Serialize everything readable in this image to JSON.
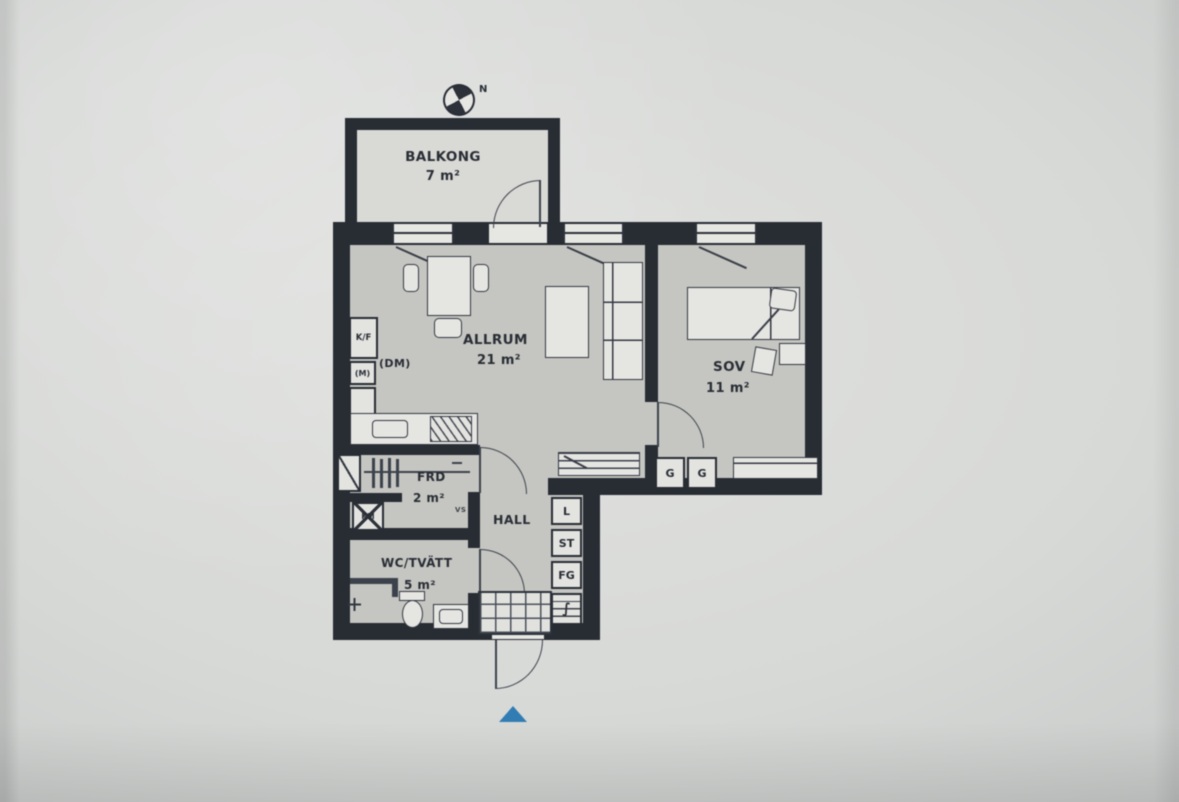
{
  "plan": {
    "compass_north": "N",
    "balcony": {
      "name": "BALKONG",
      "area": "7 m²"
    },
    "living": {
      "name": "ALLRUM",
      "area": "21 m²"
    },
    "bedroom": {
      "name": "SOV",
      "area": "11 m²"
    },
    "storage": {
      "name": "FRD",
      "area": "2 m²",
      "shaft_label": "VS"
    },
    "hall": {
      "name": "HALL"
    },
    "bath": {
      "name": "WC/TVÄTT",
      "area": "5 m²"
    },
    "kitchen": {
      "fridge_freezer": "K/F",
      "microwave": "(M)",
      "dishwasher": "(DM)"
    },
    "laundry": {
      "washing_machine": "KM",
      "el_symbol": "∫"
    },
    "wardrobes": {
      "g1": "G",
      "g2": "G",
      "linen": "L",
      "cleaning": "ST",
      "fg": "FG"
    }
  },
  "colors": {
    "wall": "#252a32",
    "floor": "#c7c8c3",
    "balcony_floor": "#dcdcd8",
    "fixture_fill": "#e8e8e5",
    "ink": "#262b33",
    "entrance_marker": "#2e7cb5",
    "screen_background": "#d7d9d7"
  }
}
